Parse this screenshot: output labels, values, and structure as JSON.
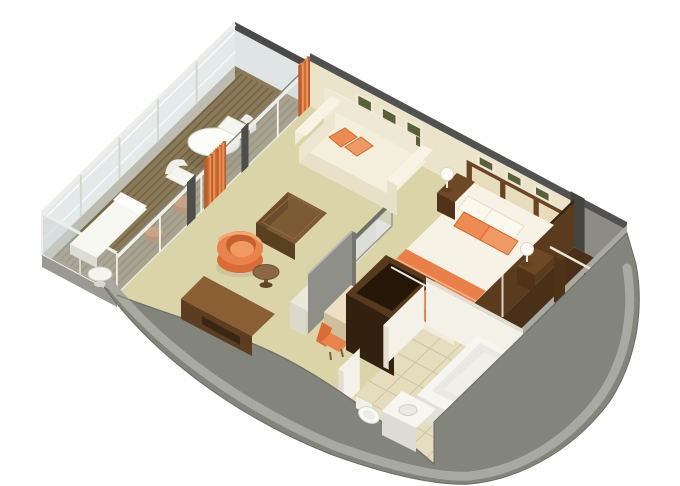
{
  "meta": {
    "title": "Suite 3D Floor Plan",
    "view": "isometric-cutaway"
  },
  "rooms": [
    {
      "id": "balcony",
      "label": "veranda",
      "furniture": [
        "round-dining-table",
        "two-white-chairs",
        "chaise-lounge",
        "side-table",
        "deck-stool",
        "deck-stool-small",
        "glass-railing",
        "teak-deck"
      ]
    },
    {
      "id": "living",
      "label": "living-room",
      "furniture": [
        "sofa",
        "orange-pillows",
        "ottoman",
        "tub-chair",
        "round-side-table",
        "console-desk",
        "three-wall-frames",
        "divider-console",
        "divider-glass",
        "divider-panel"
      ]
    },
    {
      "id": "bedroom",
      "label": "bedroom",
      "furniture": [
        "double-bed",
        "orange-runner",
        "white-pillows",
        "orange-pillows",
        "nightstand-left",
        "nightstand-right",
        "sphere-lamps",
        "writing-desk",
        "desk-chair",
        "tv-cabinet",
        "headboard-panels",
        "three-small-frames"
      ]
    },
    {
      "id": "bathroom",
      "label": "bathroom",
      "furniture": [
        "bathtub",
        "vanity-sink",
        "toilet",
        "tiled-floor"
      ]
    },
    {
      "id": "closet",
      "label": "walk-in-closet",
      "furniture": [
        "wardrobe-doors",
        "hanging-rail"
      ]
    }
  ],
  "colors": {
    "background": "#ffffff",
    "deck": "#8b7a58",
    "deckStripe": "#665538",
    "glassTint": "#c9d4d4",
    "railWhite": "#eeeee8",
    "railPost": "#d6d6ce",
    "fascia": "#bcbcb2",
    "partitionDark": "#4a4a48",
    "jambDark": "#4e4e4c",
    "wallCream": "#ece3cb",
    "wallTopDark": "#525250",
    "grayWall": "#8c8c84",
    "carpet": "#dbd4a9",
    "hullFace": "#83847c",
    "hullTop": "#a8a9a1",
    "hullEdge": "#6b6c64",
    "closetFloor": "#4a3019",
    "closetWall": "#5b3b1d",
    "closetInner": "#6b4423",
    "closetDoor": "#4e3317",
    "tile": "#e6ddbf",
    "tileLine": "#cdc3a2",
    "bathWall": "#f4f1e8",
    "bathWallShade": "#e2dfd2",
    "fixtureWhite": "#f7f5ef",
    "fixtureShade": "#e9e9e1",
    "sofaCream": "#f4eedd",
    "sofaShade": "#e8e0c8",
    "sofaSide": "#ede5cf",
    "sofaBright": "#f8f3e4",
    "pillowOrange": "#ee8b52",
    "pillowOrangeDeep": "#d06a32",
    "pillowOrangeSoft": "#f09a63",
    "ottomanTop": "#7c5a34",
    "ottomanSide": "#6b4b2b",
    "ottomanFront": "#59401f",
    "chairOrange": "#e8834d",
    "chairOrangeDeep": "#c65f30",
    "chairOrangeSoft": "#ef9a62",
    "woodTable": "#8a6845",
    "woodTableDeep": "#6f5234",
    "duvet": "#f6f2e6",
    "bedSide": "#ece7d8",
    "runner": "#ea8048",
    "runnerDeep": "#d96b35",
    "nightstand": "#6f4826",
    "nightstandDeep": "#5d3b1e",
    "nightstandFront": "#4f3218",
    "lampWhite": "#fdfcf8",
    "tvCabinet": "#46301a",
    "tvCabinetDeep": "#332110",
    "tvCabinetTop": "#57391c",
    "tvCabinetInner": "#241707",
    "deskCream": "#ecdfc4",
    "deskCreamSide": "#ddceb0",
    "deskBrown": "#8a5f33",
    "deskBrownSide": "#6b4526",
    "deskBrownFront": "#5c3d22",
    "deskBrownDeep": "#3a2713",
    "dividerGray": "#8e8f89",
    "consoleWhite": "#f2efe7",
    "frameCream": "#efe9d8",
    "artOlive": "#5c6038",
    "headboard": "#6a4423",
    "panelCream": "#e7dcbc",
    "curtainA": "#b85f2e",
    "curtainB": "#ef9055",
    "curtainC": "#cf6d36"
  }
}
